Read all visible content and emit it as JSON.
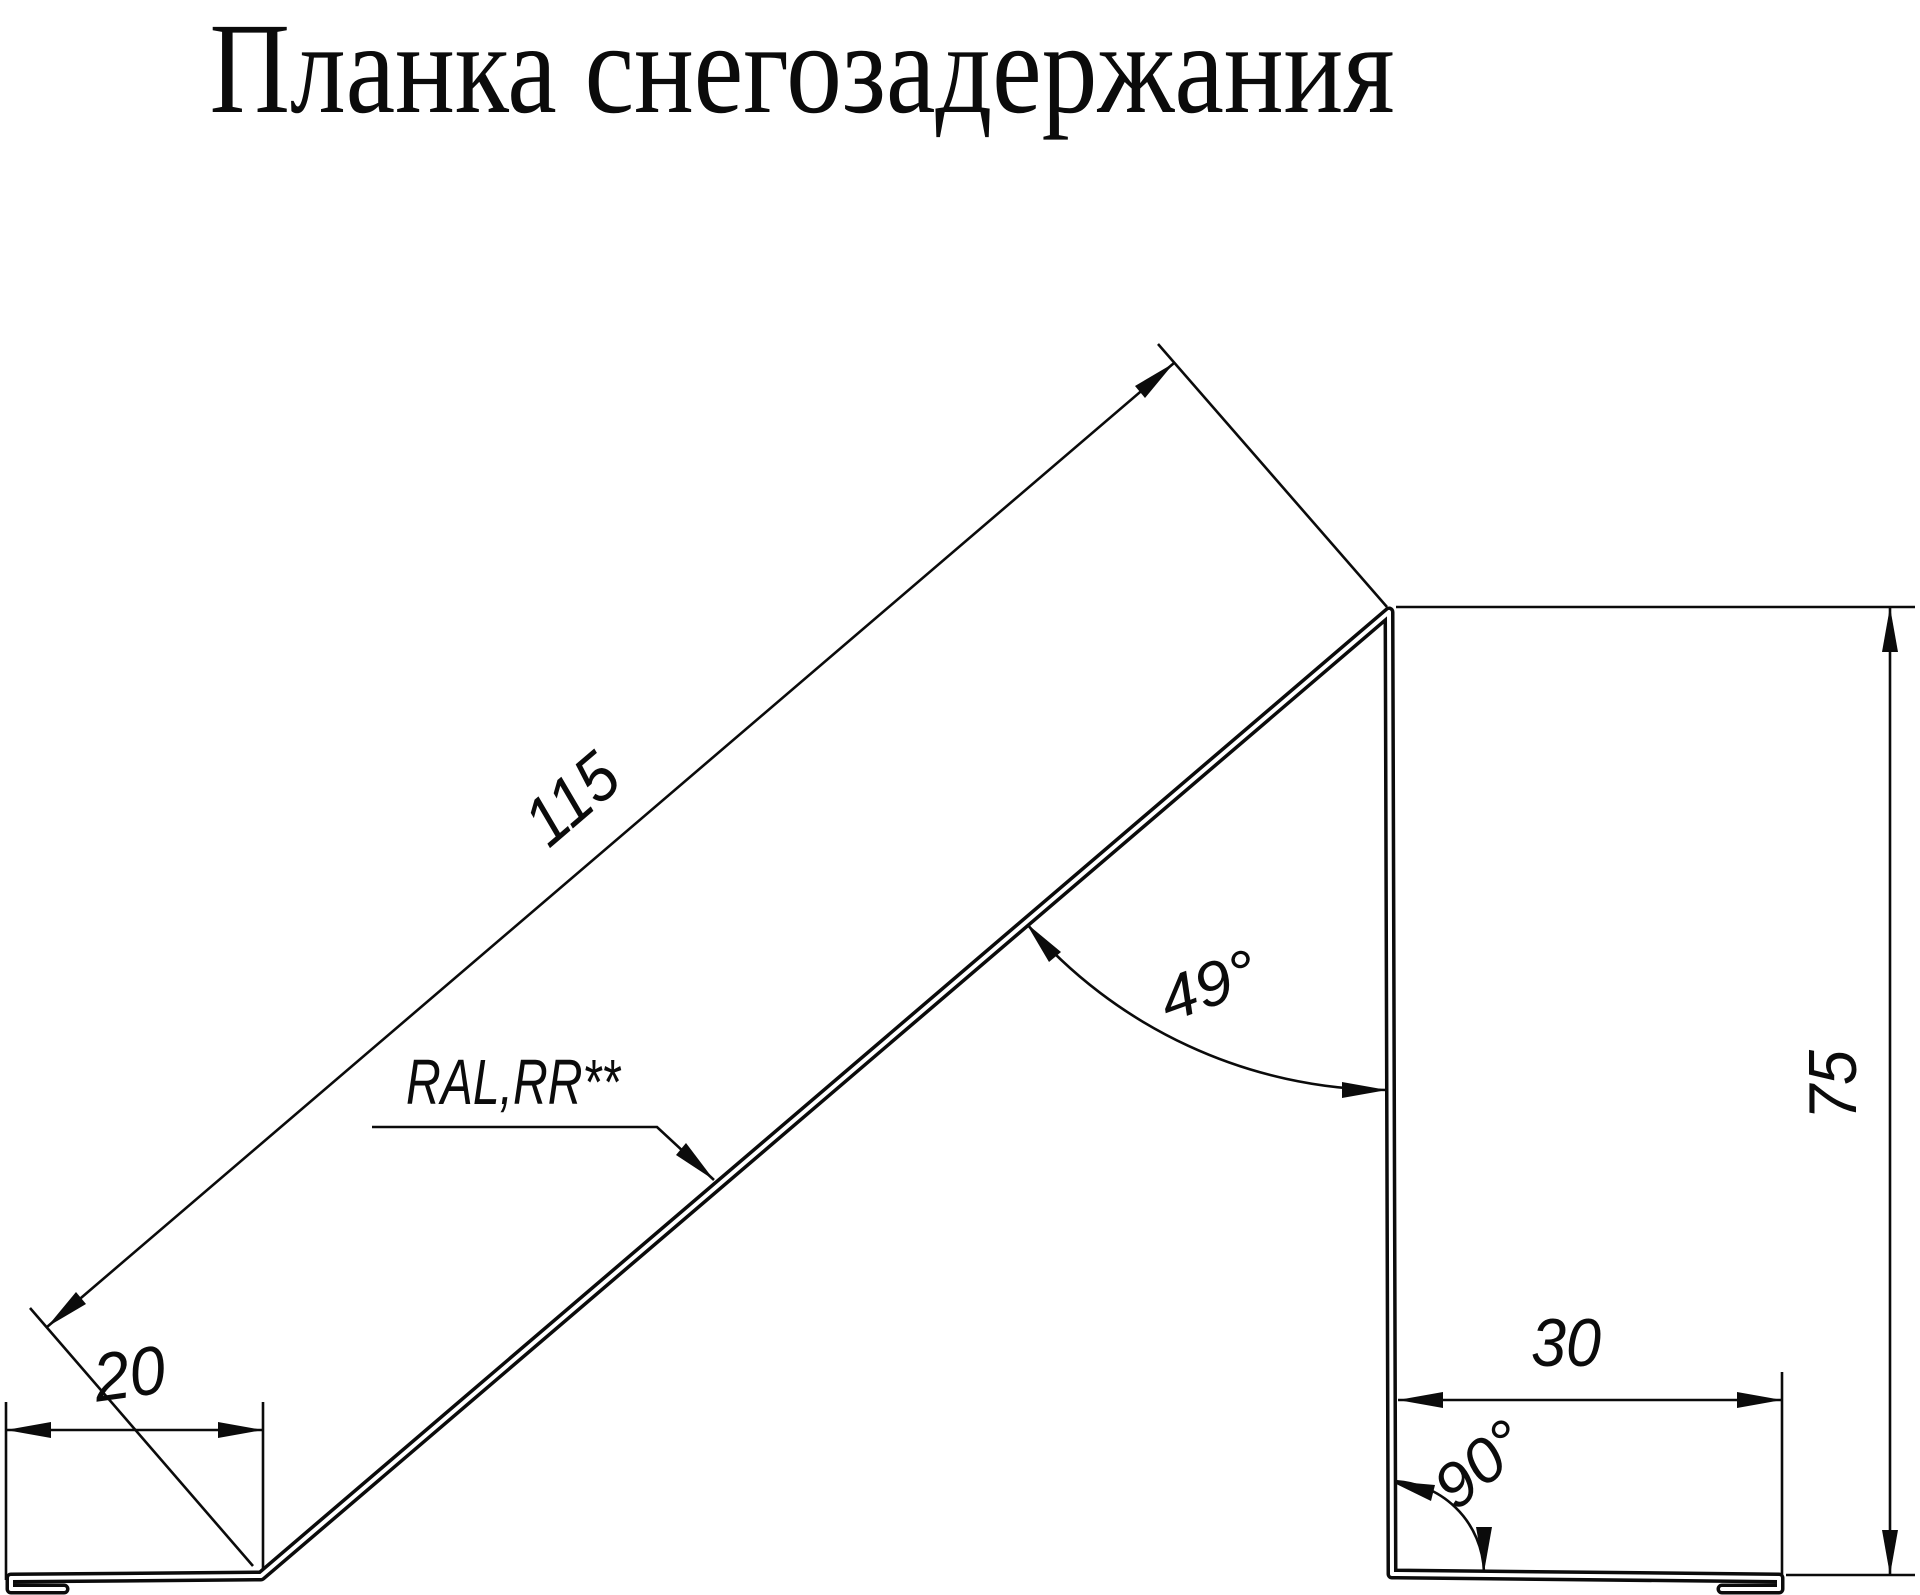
{
  "title": "Планка снегозадержания",
  "labels": {
    "slope_length": "115",
    "left_flange": "20",
    "right_flange": "30",
    "height": "75",
    "slope_angle": "49°",
    "bottom_angle": "90°",
    "coating": "RAL,RR**"
  },
  "colors": {
    "line": "#000000",
    "background": "#ffffff"
  }
}
